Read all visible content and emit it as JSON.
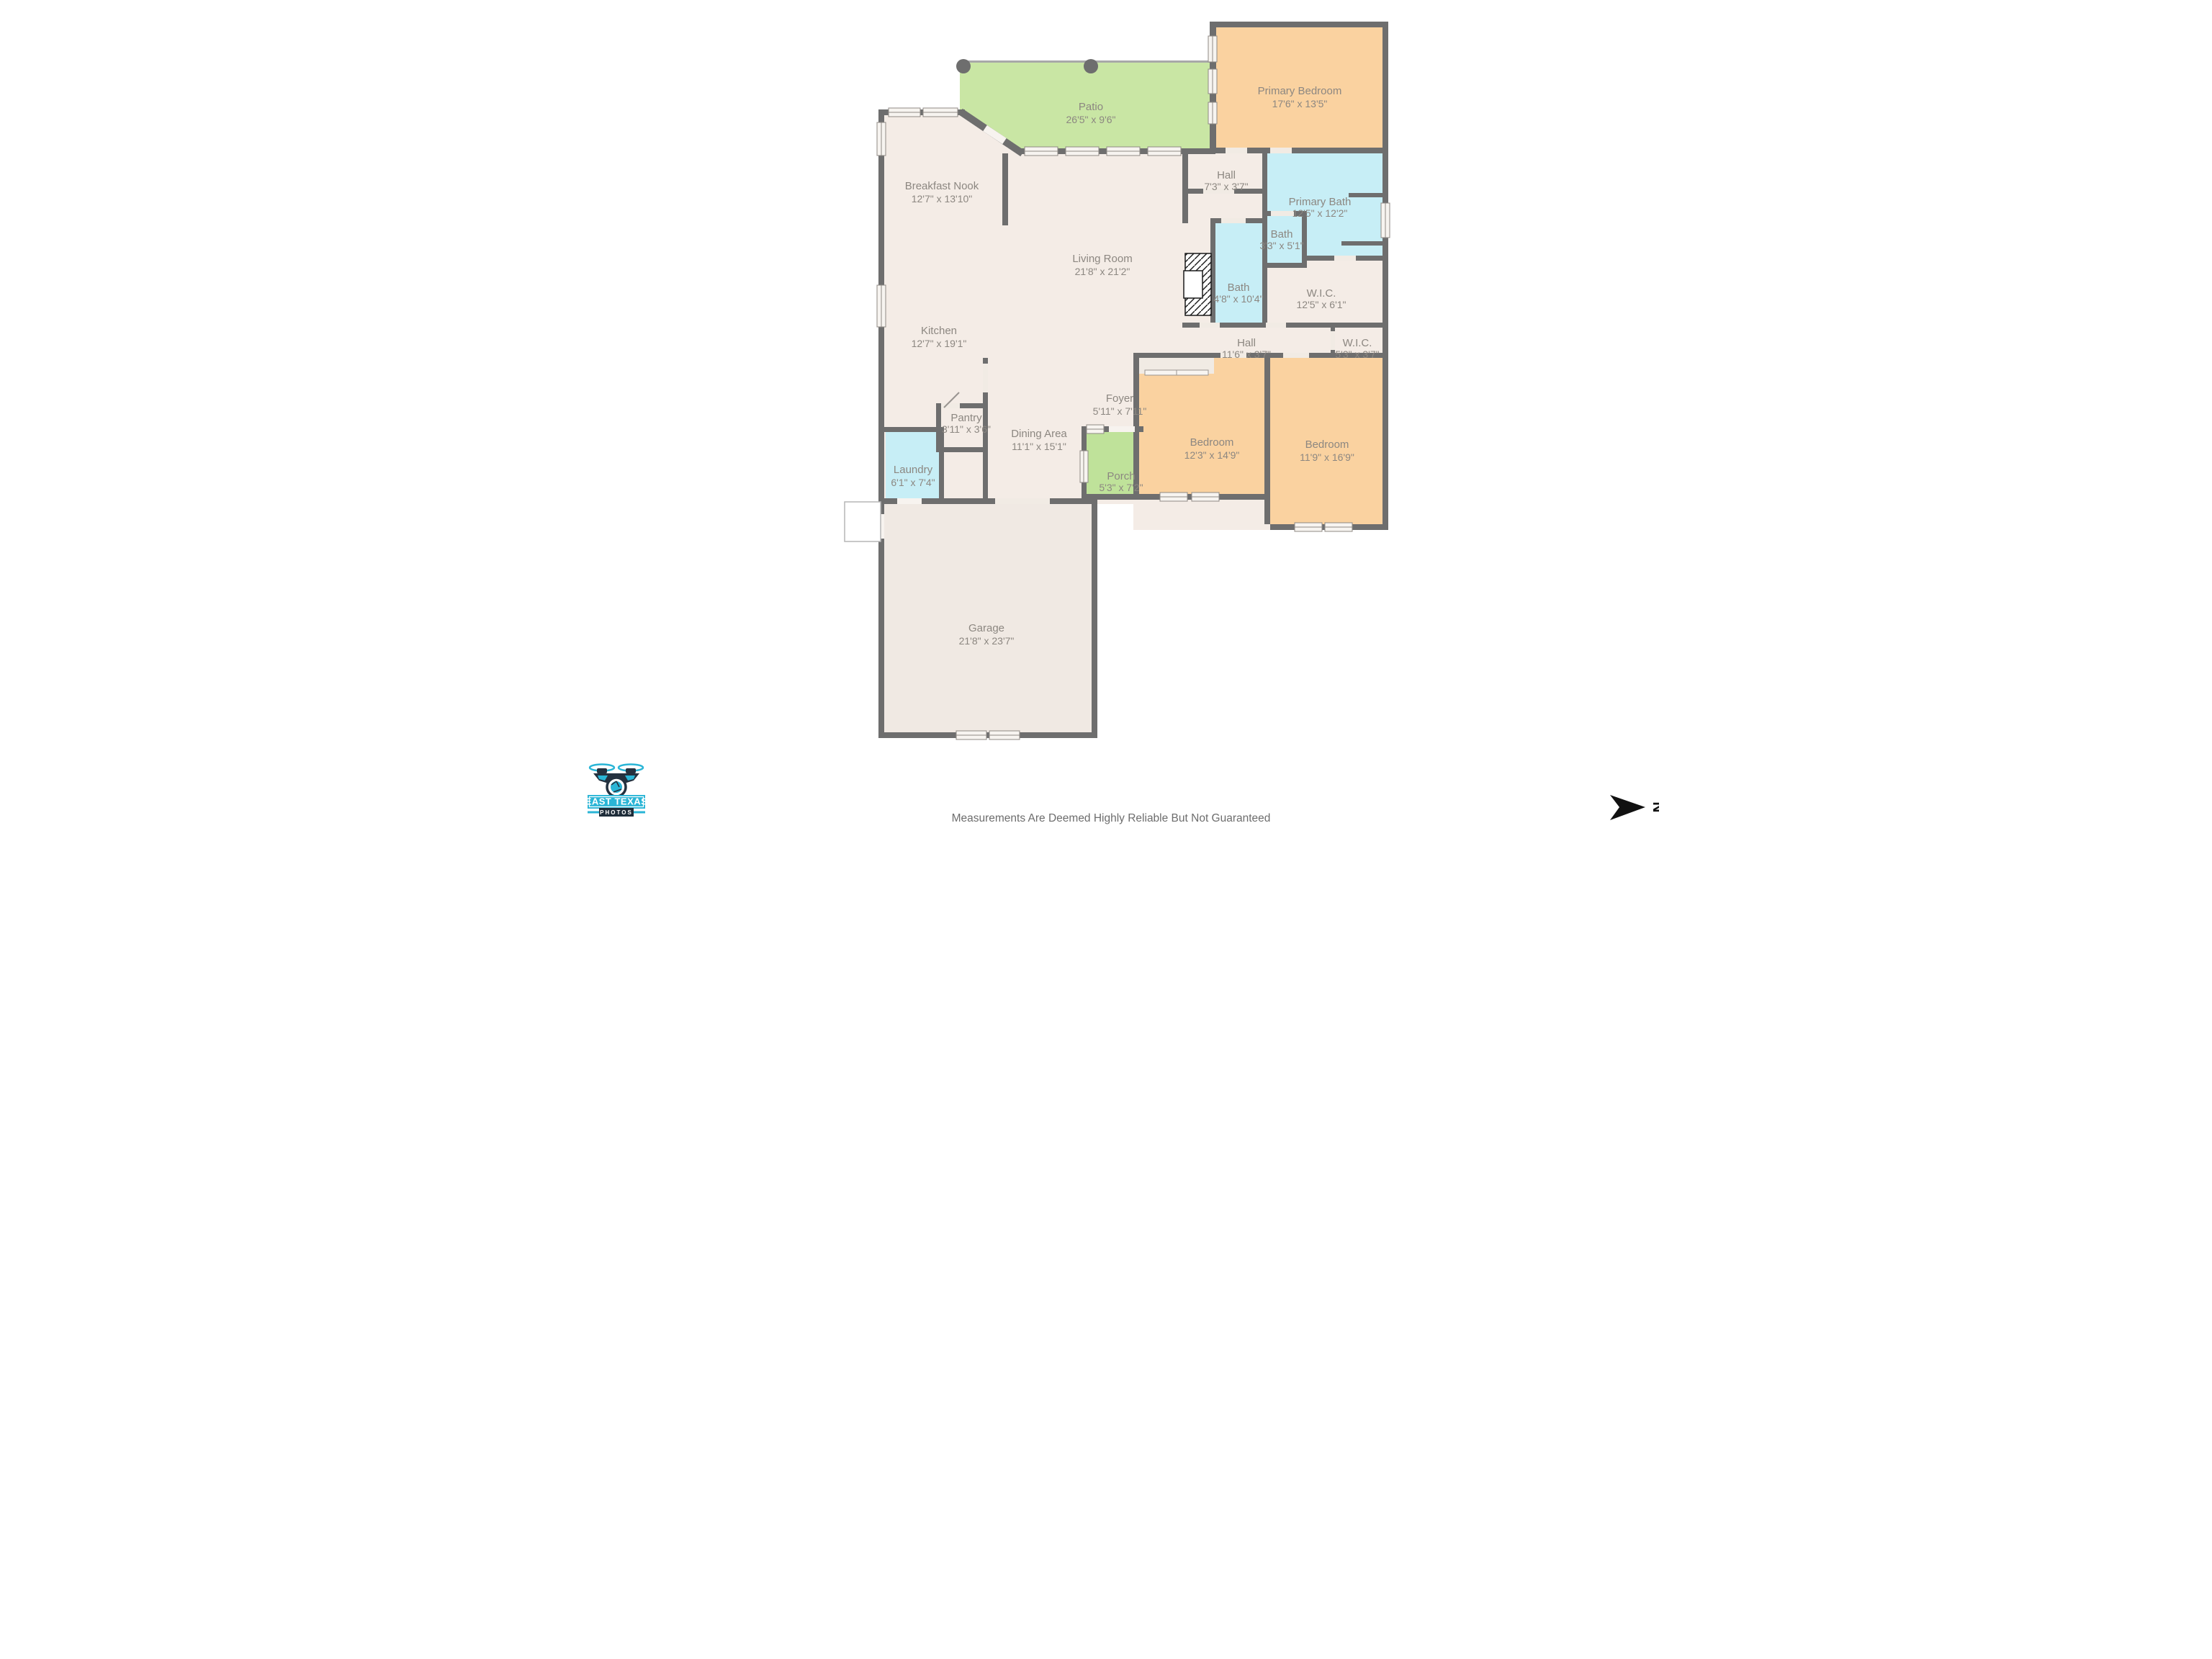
{
  "rooms": {
    "patio": {
      "name": "Patio",
      "dims": "26'5\" x 9'6\""
    },
    "primary_bedroom": {
      "name": "Primary Bedroom",
      "dims": "17'6\" x 13'5\""
    },
    "breakfast_nook": {
      "name": "Breakfast Nook",
      "dims": "12'7\" x 13'10\""
    },
    "hall_upper": {
      "name": "Hall",
      "dims": "7'3\" x 3'7\""
    },
    "primary_bath": {
      "name": "Primary Bath",
      "dims": "12'5\" x 12'2\""
    },
    "bath_small": {
      "name": "Bath",
      "dims": "3'3\" x 5'1\""
    },
    "living_room": {
      "name": "Living Room",
      "dims": "21'8\" x 21'2\""
    },
    "bath_hall": {
      "name": "Bath",
      "dims": "4'8\" x 10'4\""
    },
    "wic_primary": {
      "name": "W.I.C.",
      "dims": "12'5\" x 6'1\""
    },
    "kitchen": {
      "name": "Kitchen",
      "dims": "12'7\" x 19'1\""
    },
    "hall_lower": {
      "name": "Hall",
      "dims": "11'6\" x 3'7\""
    },
    "wic_small": {
      "name": "W.I.C.",
      "dims": "5'3\" x 3'7\""
    },
    "foyer": {
      "name": "Foyer",
      "dims": "5'11\" x 7'11\""
    },
    "pantry": {
      "name": "Pantry",
      "dims": "3'11\" x 3'6\""
    },
    "dining": {
      "name": "Dining Area",
      "dims": "11'1\" x 15'1\""
    },
    "laundry": {
      "name": "Laundry",
      "dims": "6'1\" x 7'4\""
    },
    "porch": {
      "name": "Porch",
      "dims": "5'3\" x 7'2\""
    },
    "bedroom_left": {
      "name": "Bedroom",
      "dims": "12'3\" x 14'9\""
    },
    "bedroom_right": {
      "name": "Bedroom",
      "dims": "11'9\" x 16'9\""
    },
    "garage": {
      "name": "Garage",
      "dims": "21'8\" x 23'7\""
    }
  },
  "branding": {
    "logo_line1": "EAST TEXAS",
    "logo_line2": "PHOTOS"
  },
  "compass": {
    "north_label": "N"
  },
  "footer": {
    "disclaimer": "Measurements Are Deemed Highly Reliable But Not Guaranteed"
  },
  "colors": {
    "wall": "#6e6e6e",
    "floor": "#f4ece6",
    "bedroom_fill": "#fad2a0",
    "bath_fill": "#c7eef6",
    "patio_fill": "#c9e6a4",
    "porch_fill": "#bfe29a",
    "logo_cyan": "#2ab5d6",
    "logo_dark": "#24313f"
  }
}
